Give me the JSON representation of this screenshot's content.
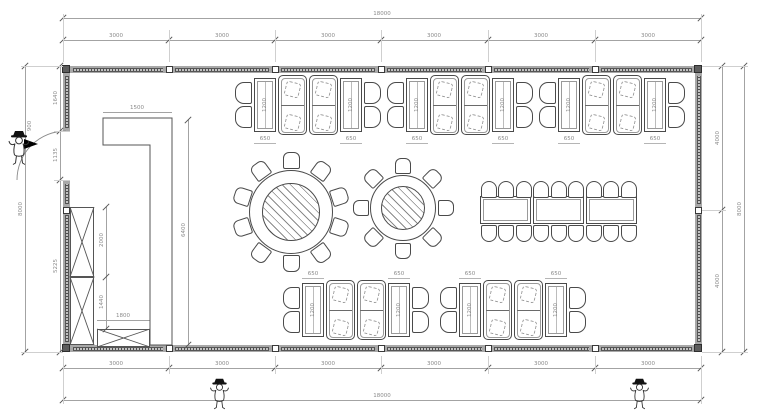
{
  "title": "dining room floor plan",
  "dims": {
    "total_width_top": "18000",
    "total_width_bottom": "18000",
    "total_height_left": "8000",
    "total_height_right": "8000",
    "top_segments": [
      "3000",
      "3000",
      "3000",
      "3000",
      "3000",
      "3000"
    ],
    "bottom_segments": [
      "3000",
      "3000",
      "3000",
      "3000",
      "3000",
      "3000"
    ],
    "left_segments": [
      "1640",
      "1135",
      "5225"
    ],
    "right_segments": [
      "4000",
      "4000"
    ],
    "counter_arm_width": "1500",
    "counter_run_height": "6400",
    "cabinet_upper": "2000",
    "cabinet_lower": "1440",
    "side_counter_width": "1800",
    "door_leaf": "900",
    "booth_table_width": "650",
    "booth_table_length": "1200"
  },
  "furniture": {
    "top_booth_groups": 3,
    "bottom_booth_groups": 2,
    "round_tables": [
      {
        "chairs": 10
      },
      {
        "chairs": 8
      }
    ],
    "long_table_sections": 3,
    "long_table_chairs_per_side": 9
  },
  "colors": {
    "wall_fill": "#a8a8a8",
    "window_band": "#4e4e4e",
    "furniture_line": "#4a4a4a",
    "dim_line": "#a3a3a3",
    "dim_text": "#8a8a8a"
  }
}
